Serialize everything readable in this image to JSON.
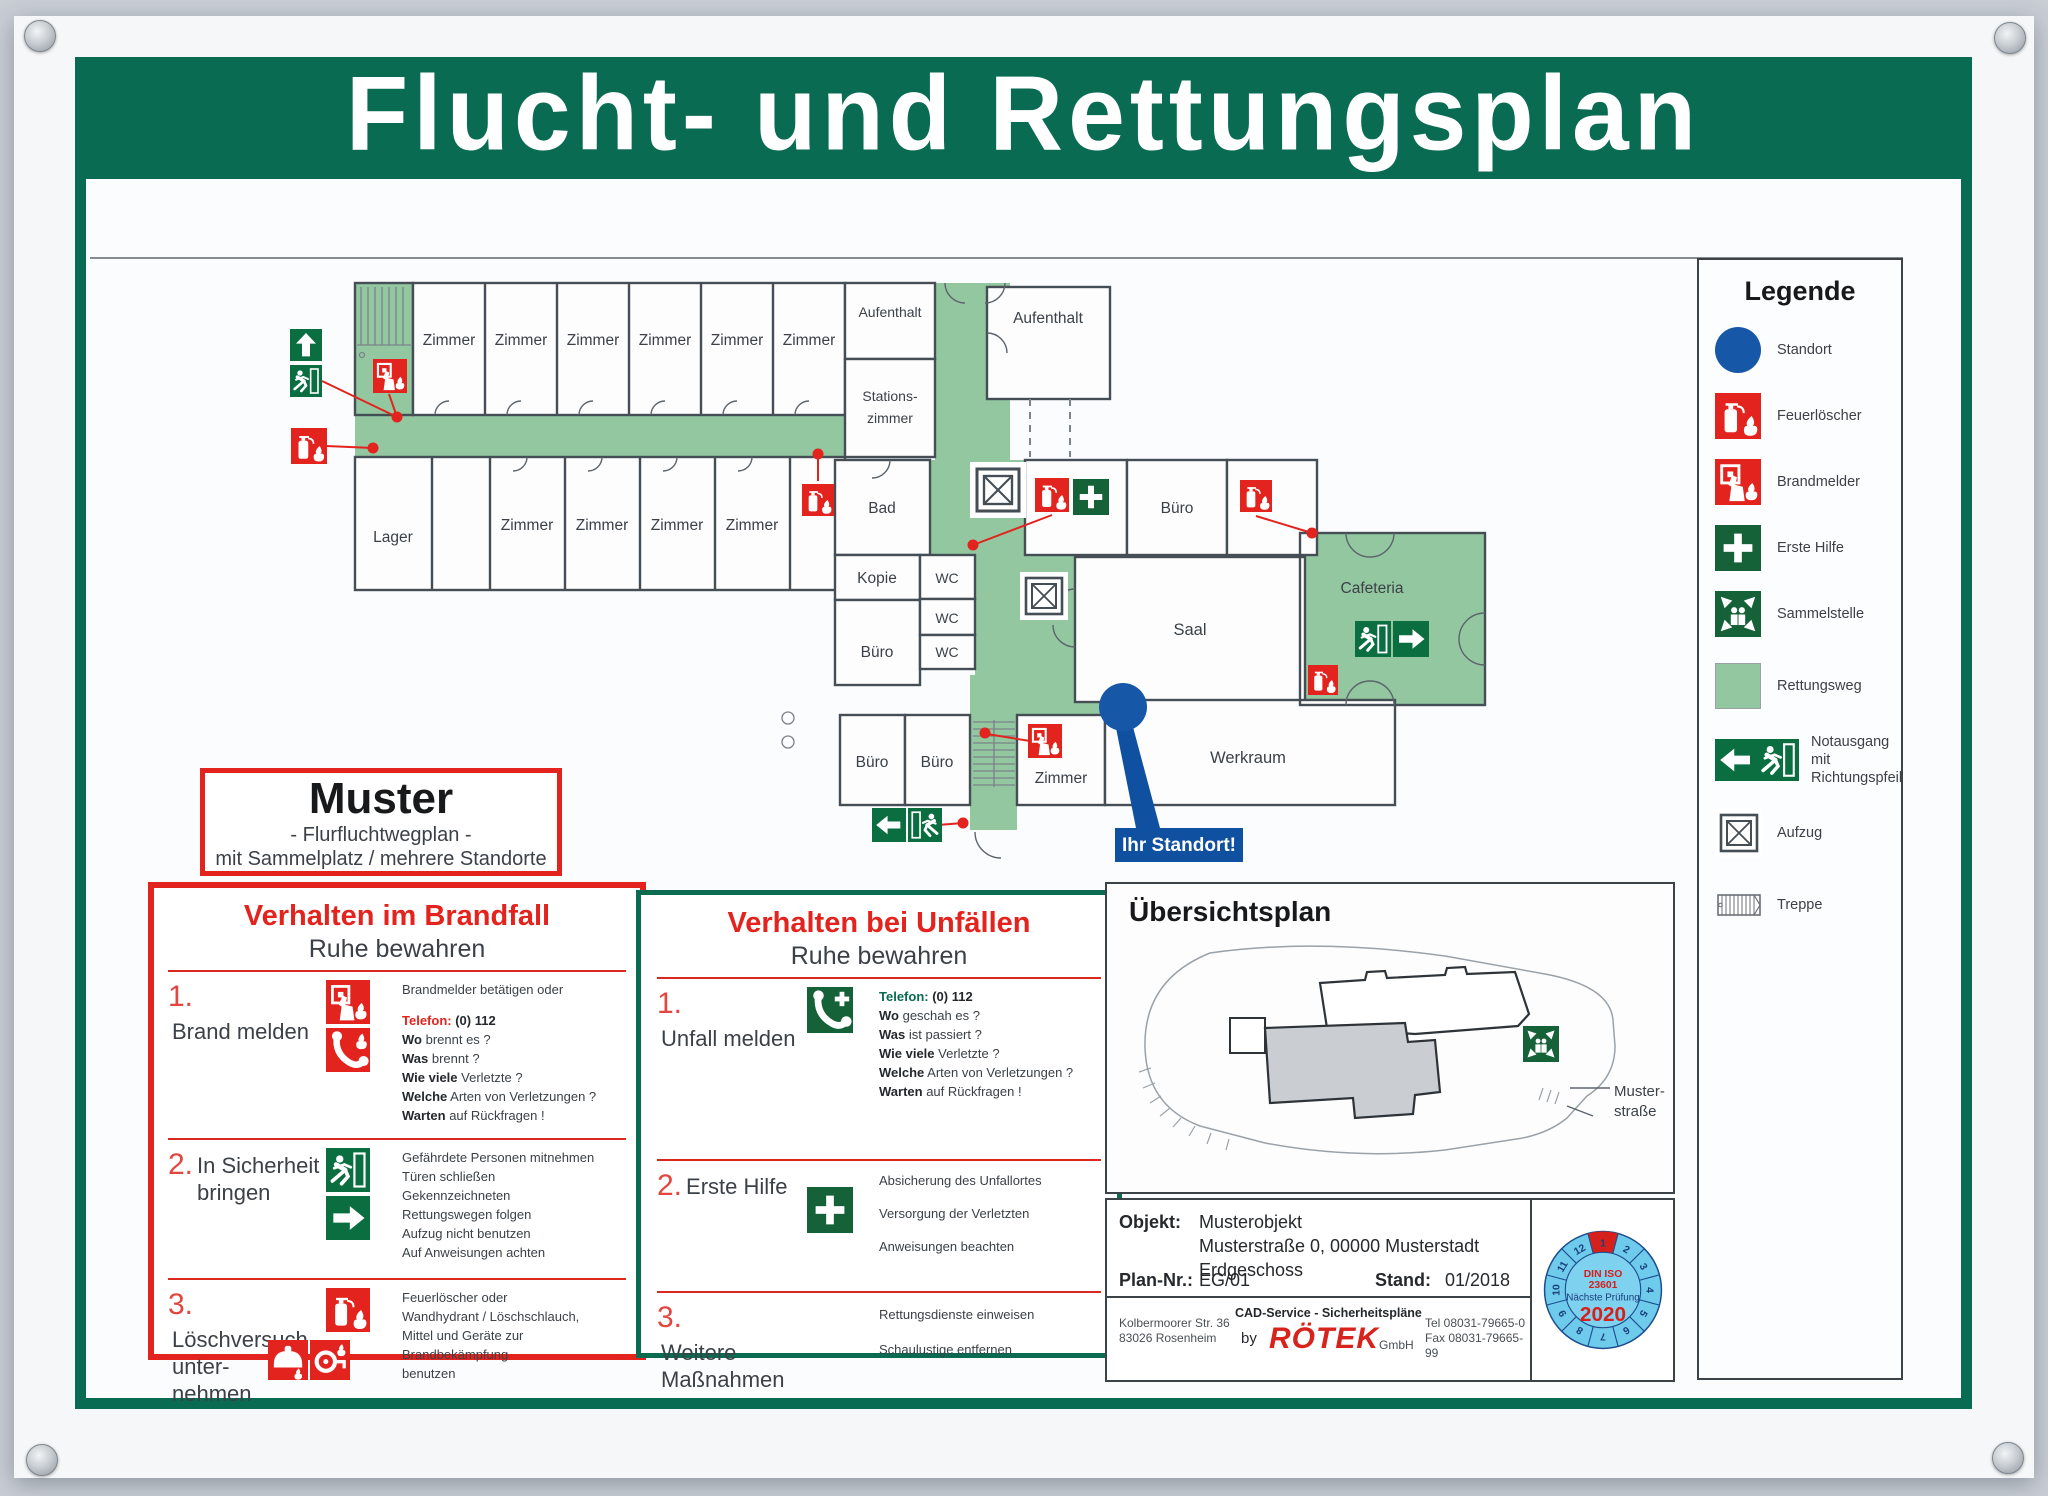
{
  "title": "Flucht- und Rettungsplan",
  "colors": {
    "frame_green": "#086B52",
    "route_green": "#92C7A0",
    "safety_red": "#E3231D",
    "exit_green": "#0B6E41",
    "firstaid_green": "#156239",
    "standort_blue": "#1757A8",
    "badge_blue": "#6FCBEC"
  },
  "muster_box": {
    "title": "Muster",
    "subtitle1": "- Flurfluchtwegplan -",
    "subtitle2": "mit Sammelplatz / mehrere Standorte"
  },
  "legend": {
    "title": "Legende",
    "items": [
      {
        "icon": "standort-icon",
        "label": "Standort"
      },
      {
        "icon": "fire-extinguisher-icon",
        "label": "Feuerlöscher"
      },
      {
        "icon": "fire-alarm-icon",
        "label": "Brandmelder"
      },
      {
        "icon": "first-aid-icon",
        "label": "Erste Hilfe"
      },
      {
        "icon": "assembly-point-icon",
        "label": "Sammelstelle"
      },
      {
        "icon": "escape-route-swatch",
        "label": "Rettungsweg"
      },
      {
        "icon": "emergency-exit-icon",
        "label": "Notausgang mit Richtungspfeil"
      },
      {
        "icon": "elevator-icon",
        "label": "Aufzug"
      },
      {
        "icon": "stairs-icon",
        "label": "Treppe"
      }
    ]
  },
  "plan": {
    "labels": {
      "zimmer": "Zimmer",
      "aufenthalt": "Aufenthalt",
      "stations1": "Stations-",
      "stations2": "zimmer",
      "lager": "Lager",
      "bad": "Bad",
      "kopie": "Kopie",
      "wc": "WC",
      "buero": "Büro",
      "saal": "Saal",
      "cafeteria": "Cafeteria",
      "werkraum": "Werkraum",
      "standort": "Ihr Standort!"
    }
  },
  "brandfall": {
    "title": "Verhalten im Brandfall",
    "subtitle": "Ruhe bewahren",
    "steps": [
      {
        "num": "1.",
        "label": "Brand melden",
        "lines": [
          {
            "b": "",
            "t": "Brandmelder betätigen oder"
          },
          {
            "b": "Telefon:",
            "t": " (0) 112"
          },
          {
            "b": "Wo",
            "t": " brennt es ?"
          },
          {
            "b": "Was",
            "t": " brennt ?"
          },
          {
            "b": "Wie viele",
            "t": " Verletzte ?"
          },
          {
            "b": "Welche",
            "t": " Arten von Verletzungen ?"
          },
          {
            "b": "Warten",
            "t": " auf Rückfragen !"
          }
        ]
      },
      {
        "num": "2.",
        "label": "In Sicherheit",
        "label2": "bringen",
        "lines": [
          {
            "b": "",
            "t": "Gefährdete Personen mitnehmen"
          },
          {
            "b": "",
            "t": "Türen schließen"
          },
          {
            "b": "",
            "t": "Gekennzeichneten"
          },
          {
            "b": "",
            "t": "Rettungswegen folgen"
          },
          {
            "b": "",
            "t": "Aufzug nicht benutzen"
          },
          {
            "b": "",
            "t": "Auf Anweisungen achten"
          }
        ]
      },
      {
        "num": "3.",
        "label": "Löschversuch",
        "label2": "unter-",
        "label3": "nehmen",
        "lines": [
          {
            "b": "",
            "t": "Feuerlöscher oder"
          },
          {
            "b": "",
            "t": "Wandhydrant / Löschschlauch,"
          },
          {
            "b": "",
            "t": "Mittel und Geräte zur"
          },
          {
            "b": "",
            "t": "Brandbekämpfung"
          },
          {
            "b": "",
            "t": "benutzen"
          }
        ]
      }
    ]
  },
  "unfaelle": {
    "title": "Verhalten bei Unfällen",
    "subtitle": "Ruhe bewahren",
    "steps": [
      {
        "num": "1.",
        "label": "Unfall melden",
        "lines": [
          {
            "b": "Telefon:",
            "t": " (0) 112"
          },
          {
            "b": "Wo",
            "t": " geschah es ?"
          },
          {
            "b": "Was",
            "t": " ist passiert ?"
          },
          {
            "b": "Wie viele",
            "t": " Verletzte ?"
          },
          {
            "b": "Welche",
            "t": " Arten von Verletzungen ?"
          },
          {
            "b": "Warten",
            "t": " auf Rückfragen !"
          }
        ]
      },
      {
        "num": "2.",
        "label": "Erste Hilfe",
        "lines": [
          {
            "b": "",
            "t": "Absicherung des Unfallortes"
          },
          {
            "b": "",
            "t": "Versorgung der Verletzten"
          },
          {
            "b": "",
            "t": "Anweisungen beachten"
          }
        ]
      },
      {
        "num": "3.",
        "label": "Weitere",
        "label2": "Maßnahmen",
        "lines": [
          {
            "b": "",
            "t": "Rettungsdienste einweisen"
          },
          {
            "b": "",
            "t": "Schaulustige entfernen"
          }
        ]
      }
    ]
  },
  "uebersicht": {
    "title": "Übersichtsplan",
    "street1": "Muster-",
    "street2": "straße"
  },
  "info": {
    "objekt_label": "Objekt:",
    "objekt1": "Musterobjekt",
    "objekt2": "Musterstraße 0, 00000 Musterstadt",
    "objekt3": "Erdgeschoss",
    "plannr_label": "Plan-Nr.:",
    "plannr": "EG/01",
    "stand_label": "Stand:",
    "stand": "01/2018",
    "addr1": "Kolbermoorer Str. 36",
    "addr2": "83026 Rosenheim",
    "service": "CAD-Service - Sicherheitspläne",
    "by": "by",
    "brand": "RÖTEK",
    "gmbh": "GmbH",
    "tel": "Tel 08031-79665-0",
    "fax": "Fax 08031-79665-99"
  },
  "badge": {
    "line1": "DIN ISO",
    "line2": "23601",
    "line3": "Nächste Prüfung",
    "year": "2020",
    "months": [
      "1",
      "2",
      "3",
      "4",
      "5",
      "6",
      "7",
      "8",
      "9",
      "10",
      "11",
      "12"
    ]
  }
}
